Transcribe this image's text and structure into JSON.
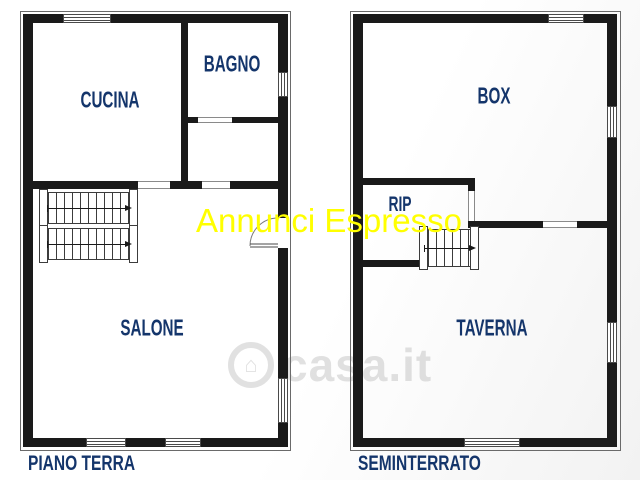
{
  "watermarks": {
    "agency": "Annunci Espresso",
    "portal": "casa.it"
  },
  "floors": [
    {
      "caption": "PIANO TERRA",
      "rooms": [
        {
          "label": "CUCINA"
        },
        {
          "label": "BAGNO"
        },
        {
          "label": "SALONE"
        }
      ]
    },
    {
      "caption": "SEMINTERRATO",
      "rooms": [
        {
          "label": "BOX"
        },
        {
          "label": "RIP"
        },
        {
          "label": "TAVERNA"
        }
      ]
    }
  ],
  "colors": {
    "wall": "#1a1a1a",
    "room_label": "#14356b",
    "agency_watermark": "#ffff00",
    "portal_watermark": "#a8a8a8",
    "background": "#ffffff"
  }
}
